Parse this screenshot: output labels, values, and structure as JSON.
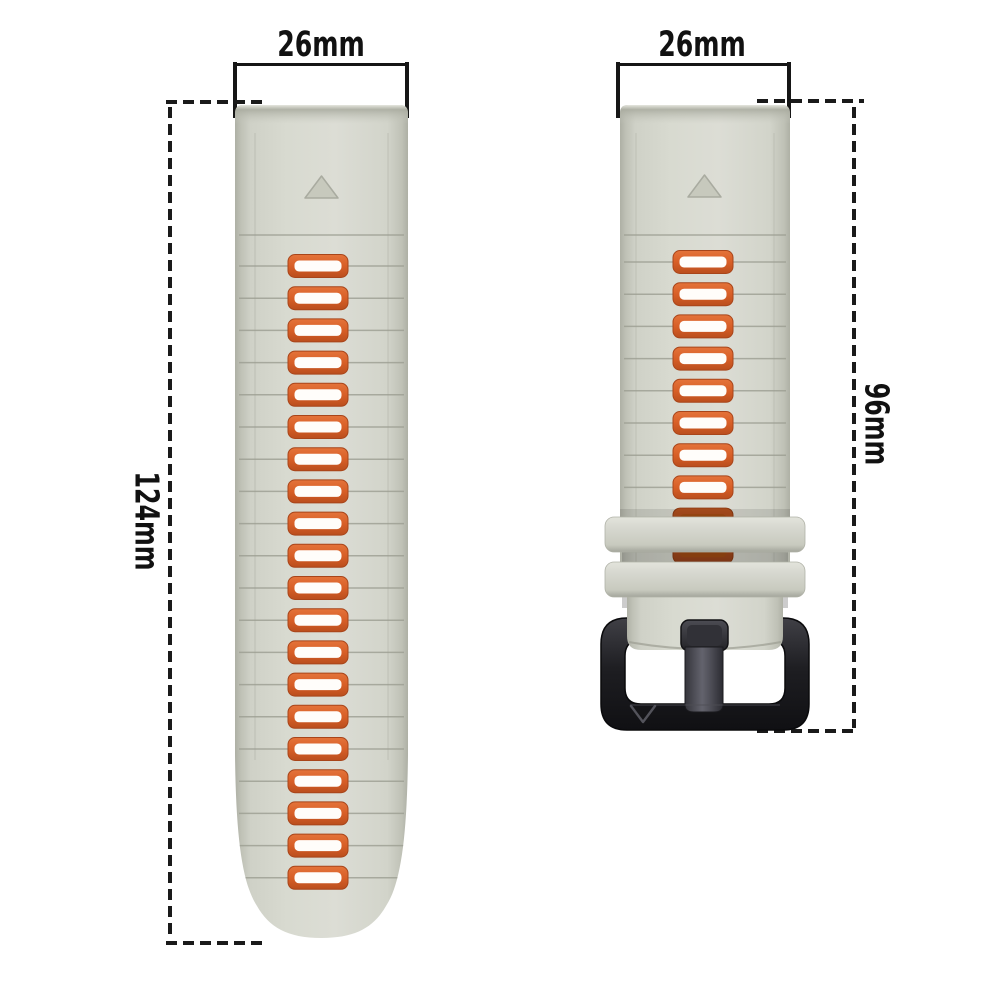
{
  "image": {
    "type": "watch-strap-dimension-diagram",
    "background": "#ffffff"
  },
  "annotations": {
    "left_strap_width": "26mm",
    "right_strap_width": "26mm",
    "left_strap_length": "124mm",
    "right_strap_length": "96mm"
  },
  "figure": {
    "left_strap": {
      "holes": 20,
      "first_hole_y": 161,
      "hole_spacing": 32.2,
      "hole_cx": 83,
      "groove_above_first": 130,
      "triangle_marker": true
    },
    "right_strap": {
      "holes": 10,
      "first_hole_y": 157,
      "hole_spacing": 32.2,
      "hole_cx": 103,
      "groove_above_first": 130,
      "dark_from": 8,
      "keepers": 2,
      "buckle_logo": "V",
      "triangle_marker": true
    },
    "colors": {
      "strap_base": "#d8dad0",
      "strap_edge": "#aeb0a5",
      "groove": "#9c9e92",
      "accent_orange": "#d85f27",
      "hole_inner": "#fffdfa",
      "buckle_black": "#1e1e22",
      "dimension_ink": "#161616"
    }
  }
}
